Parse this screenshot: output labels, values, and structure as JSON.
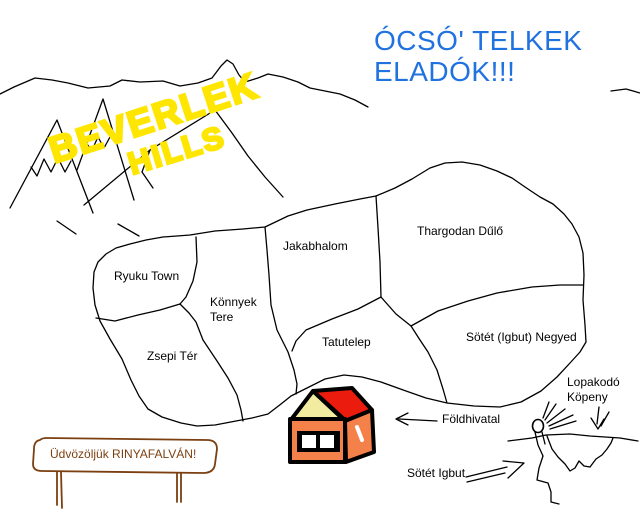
{
  "headline": {
    "line1": "ÓCSÓ' TELKEK",
    "line2": "ELADÓK!!!",
    "color": "#1F72E0"
  },
  "hills": {
    "word1": "BEVERLEK",
    "word2": "HILLS",
    "color": "#FFE600"
  },
  "map": {
    "regions": [
      {
        "id": "ryuku-town",
        "label": "Ryuku Town"
      },
      {
        "id": "jakabhalom",
        "label": "Jakabhalom"
      },
      {
        "id": "thargodan-dulo",
        "label": "Thargodan Dűlő"
      },
      {
        "id": "konnyek-tere",
        "label": "Könnyek Tere"
      },
      {
        "id": "zsepi-ter",
        "label": "Zsepi Tér"
      },
      {
        "id": "tatutelep",
        "label": "Tatutelep"
      },
      {
        "id": "sotet-igbut-negyed",
        "label": "Sötét (Igbut) Negyed"
      }
    ]
  },
  "callouts": {
    "foldhivatal": {
      "label": "Földhivatal"
    },
    "sotet_igbut": {
      "label": "Sötét Igbut"
    },
    "lopakodo": {
      "label": "Lopakodó Köpeny"
    }
  },
  "sign": {
    "label": "Üdvözöljük RINYAFALVÁN!",
    "color": "#7B3F10"
  },
  "colors": {
    "ink": "#000000",
    "house_wall": "#F5814A",
    "house_roof": "#EB1C0E",
    "house_gable": "#F2ECA0",
    "sign_brown": "#7B3F10"
  }
}
